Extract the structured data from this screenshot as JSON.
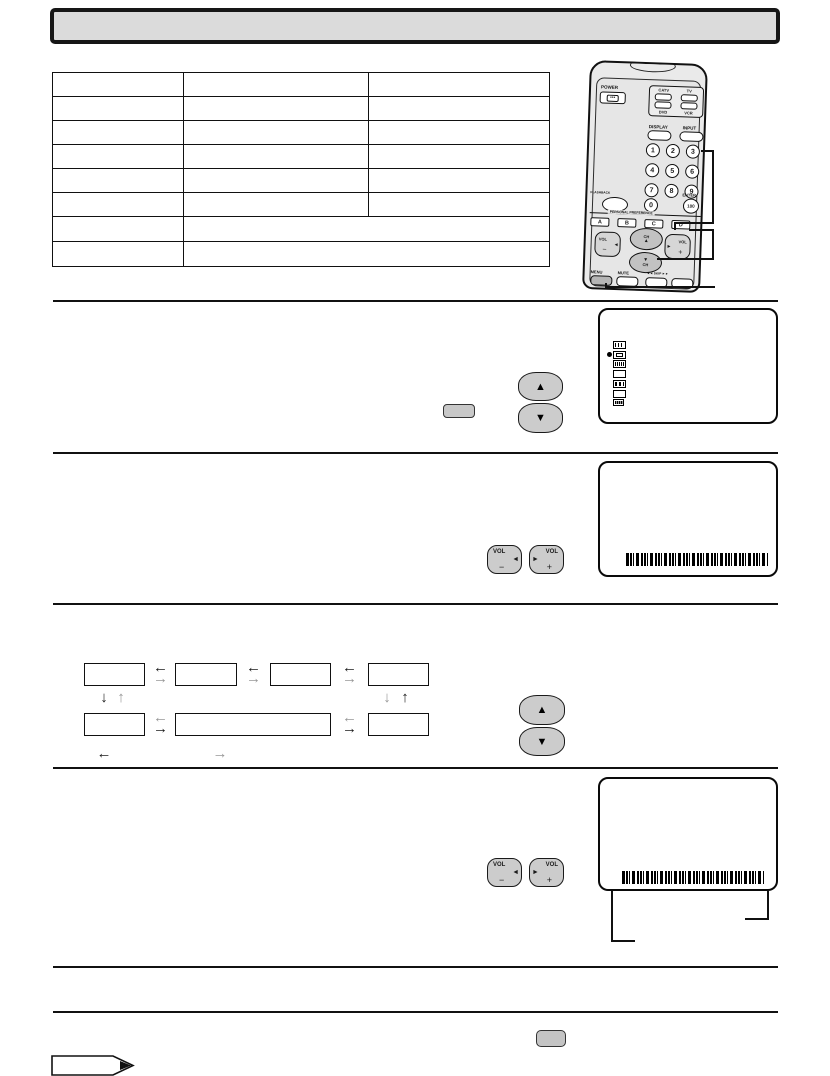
{
  "document": {
    "title_banner": ""
  },
  "table": {
    "rows": [
      [
        "",
        "",
        ""
      ],
      [
        "",
        "",
        ""
      ],
      [
        "",
        "",
        ""
      ],
      [
        "",
        "",
        ""
      ],
      [
        "",
        "",
        ""
      ],
      [
        "",
        "",
        ""
      ],
      [
        "",
        ""
      ],
      [
        "",
        ""
      ]
    ]
  },
  "remote": {
    "power_label": "POWER",
    "power_dots": "•••",
    "device_buttons": [
      "CATV",
      "TV",
      "DVD",
      "VCR"
    ],
    "display_label": "DISPLAY",
    "input_label": "INPUT",
    "digits": [
      "1",
      "2",
      "3",
      "4",
      "5",
      "6",
      "7",
      "8",
      "9"
    ],
    "flashback_label": "FLASHBACK",
    "zero_label": "0",
    "enter_label": "ENTER",
    "enter_value": "100",
    "preference_label": "PERSONAL PREFERENCE",
    "preference_buttons": [
      "A",
      "B",
      "C",
      "D"
    ],
    "vol_label": "VOL",
    "minus": "−",
    "plus": "+",
    "ch_label": "CH",
    "menu_label": "MENU",
    "mute_label": "MUTE",
    "skip_label": "◄◄ SKIP ►►"
  },
  "glyphs": {
    "up": "▲",
    "down": "▼",
    "left": "◄",
    "right": "►",
    "arrow_left": "←",
    "arrow_right": "→",
    "arrow_up": "↑",
    "arrow_down": "↓",
    "cursor": "●"
  },
  "colors": {
    "ink": "#1a1a1a",
    "gray_arrow": "#979797",
    "button_fill": "#cccccc",
    "remote_fill": "#eaeaea",
    "banner_fill": "#dbdbdb",
    "screen_border": "#0a0a0a"
  }
}
